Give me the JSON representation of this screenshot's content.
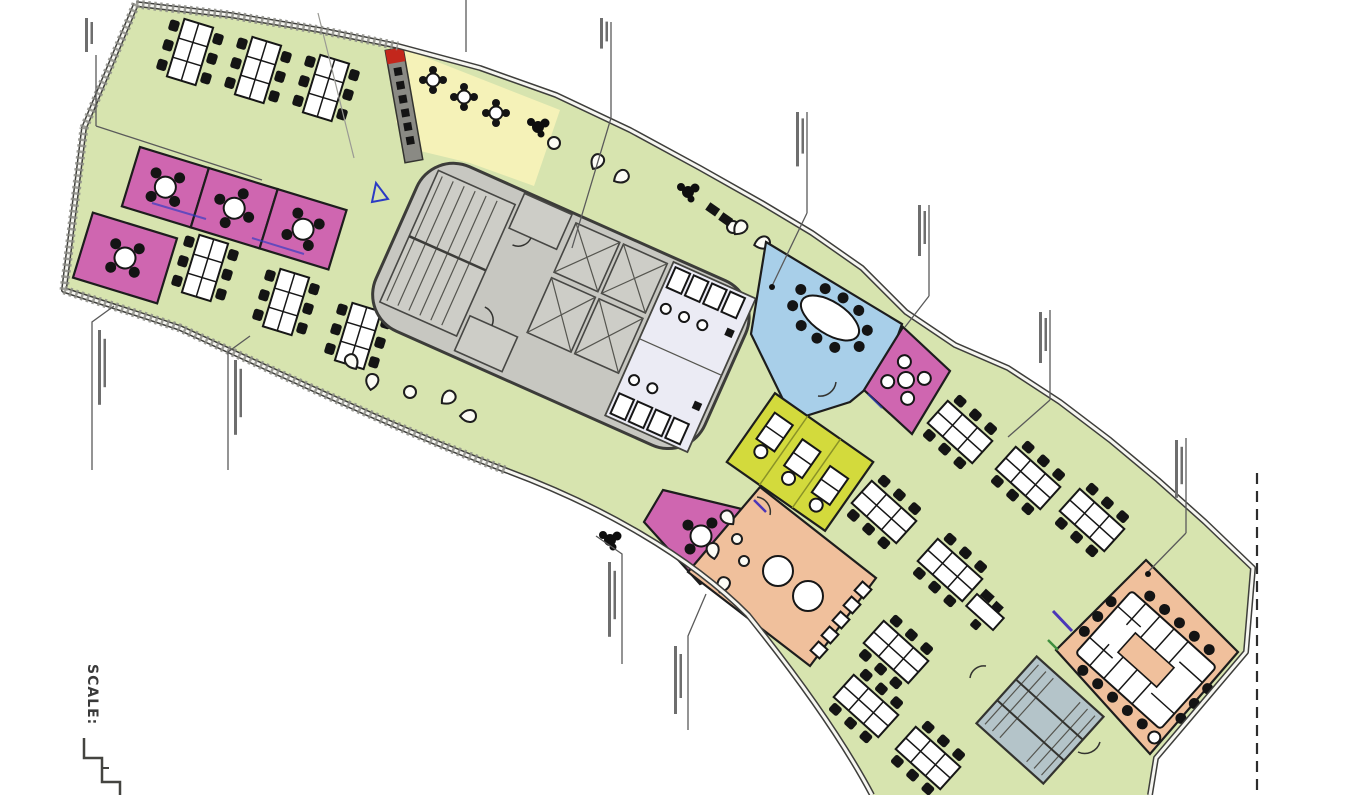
{
  "drawing": {
    "scale_label": "SCALE:"
  },
  "palette": {
    "background": "#ffffff",
    "floor_green": "#d7e4af",
    "cafe_yellow": "#f5f2b8",
    "focus_yellow_green": "#d3da3c",
    "meeting_pink": "#cf66b0",
    "meeting_blue": "#a8cfe9",
    "break_orange": "#f0c09c",
    "core_gray": "#c7c7c1",
    "restroom_lavender": "#ebebf4",
    "stair_blue_gray": "#b4c4c9",
    "counter_gray": "#8a8a84",
    "wall_dark": "#3e3e3b",
    "accent_red": "#c3271c",
    "accent_blue": "#2b3bc4",
    "accent_indigo": "#4b36b8",
    "accent_green": "#3e8e3e",
    "leader_gray": "#5a5a5a"
  },
  "zones": [
    {
      "id": "open-office-west",
      "color": "floor_green"
    },
    {
      "id": "open-office-east",
      "color": "floor_green"
    },
    {
      "id": "cafe",
      "color": "cafe_yellow"
    },
    {
      "id": "meeting-room-pink-1",
      "color": "meeting_pink"
    },
    {
      "id": "meeting-room-pink-2",
      "color": "meeting_pink"
    },
    {
      "id": "meeting-room-pink-3",
      "color": "meeting_pink"
    },
    {
      "id": "meeting-room-pink-west",
      "color": "meeting_pink"
    },
    {
      "id": "meeting-room-pink-east",
      "color": "meeting_pink"
    },
    {
      "id": "meeting-room-pink-south",
      "color": "meeting_pink"
    },
    {
      "id": "meeting-room-blue",
      "color": "meeting_blue"
    },
    {
      "id": "focus-room",
      "color": "focus_yellow_green"
    },
    {
      "id": "break-room",
      "color": "break_orange"
    },
    {
      "id": "boardroom",
      "color": "break_orange"
    },
    {
      "id": "core",
      "color": "core_gray"
    },
    {
      "id": "restrooms",
      "color": "restroom_lavender"
    },
    {
      "id": "stair-room-east",
      "color": "stair_blue_gray"
    }
  ]
}
